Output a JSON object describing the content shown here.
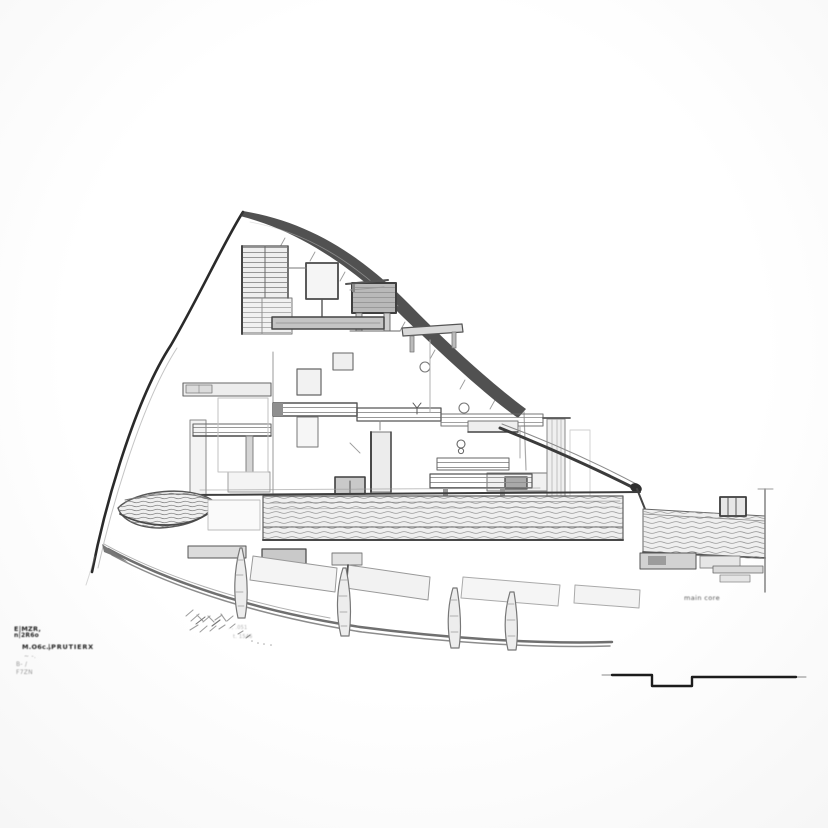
{
  "annotations": {
    "title_block": [
      "E|MZR,",
      "n|2R6o",
      "M.O6c..",
      "|PRUTIERX",
      "~ -.",
      "B- /",
      "F7ZN"
    ],
    "ground_notes": [
      ". , .051",
      "t. 1546"
    ],
    "right_label": "main core"
  },
  "colors": {
    "background": "#fdfdfd",
    "pencil_dark": "#2b2b2b",
    "pencil_mid": "#6f6f6f",
    "pencil_light": "#b5b5b5",
    "hatch": "#9a9a9a"
  }
}
